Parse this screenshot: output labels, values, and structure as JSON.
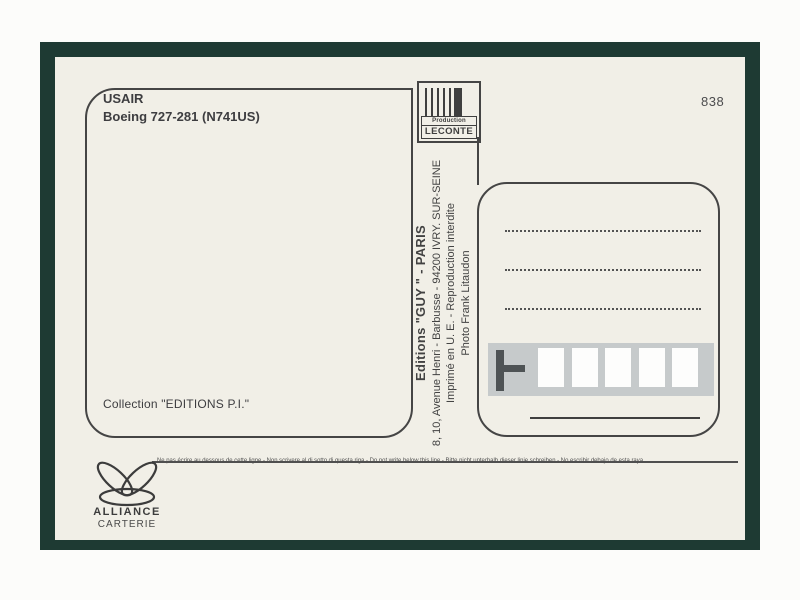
{
  "card": {
    "caption": {
      "airline": "USAIR",
      "aircraft": "Boeing 727-281 (N741US)"
    },
    "number": "838",
    "producer": {
      "label_top": "Production",
      "label_bottom": "LECONTE"
    },
    "credits": {
      "editions": "Editions \"GUY \" - PARIS",
      "address": "8, 10, Avenue Henri - Barbusse - 94200 IVRY. SUR-SEINE",
      "imprint": "Imprimé en U. E. - Reproduction interdite",
      "photo": "Photo Frank Litaudon"
    },
    "collection": "Collection \"EDITIONS P.I.\"",
    "notice": "Ne pas écrire au  dessous de cette ligne - Non scrivere al di sotto di questa riga - Do not write below this line - Bitte nicht unterhalb dieser linie schreiben - No escribir debajo de esta raya",
    "publisher": {
      "name": "ALLIANCE",
      "subtitle": "CARTERIE"
    },
    "address_area": {
      "dotted_line_count": 3,
      "postal_box_count": 5
    },
    "colors": {
      "frame_green": "#1e3a33",
      "card_cream": "#f1efe7",
      "ink": "#3f3f3f",
      "postal_strip_gray": "#c6cacb"
    }
  }
}
